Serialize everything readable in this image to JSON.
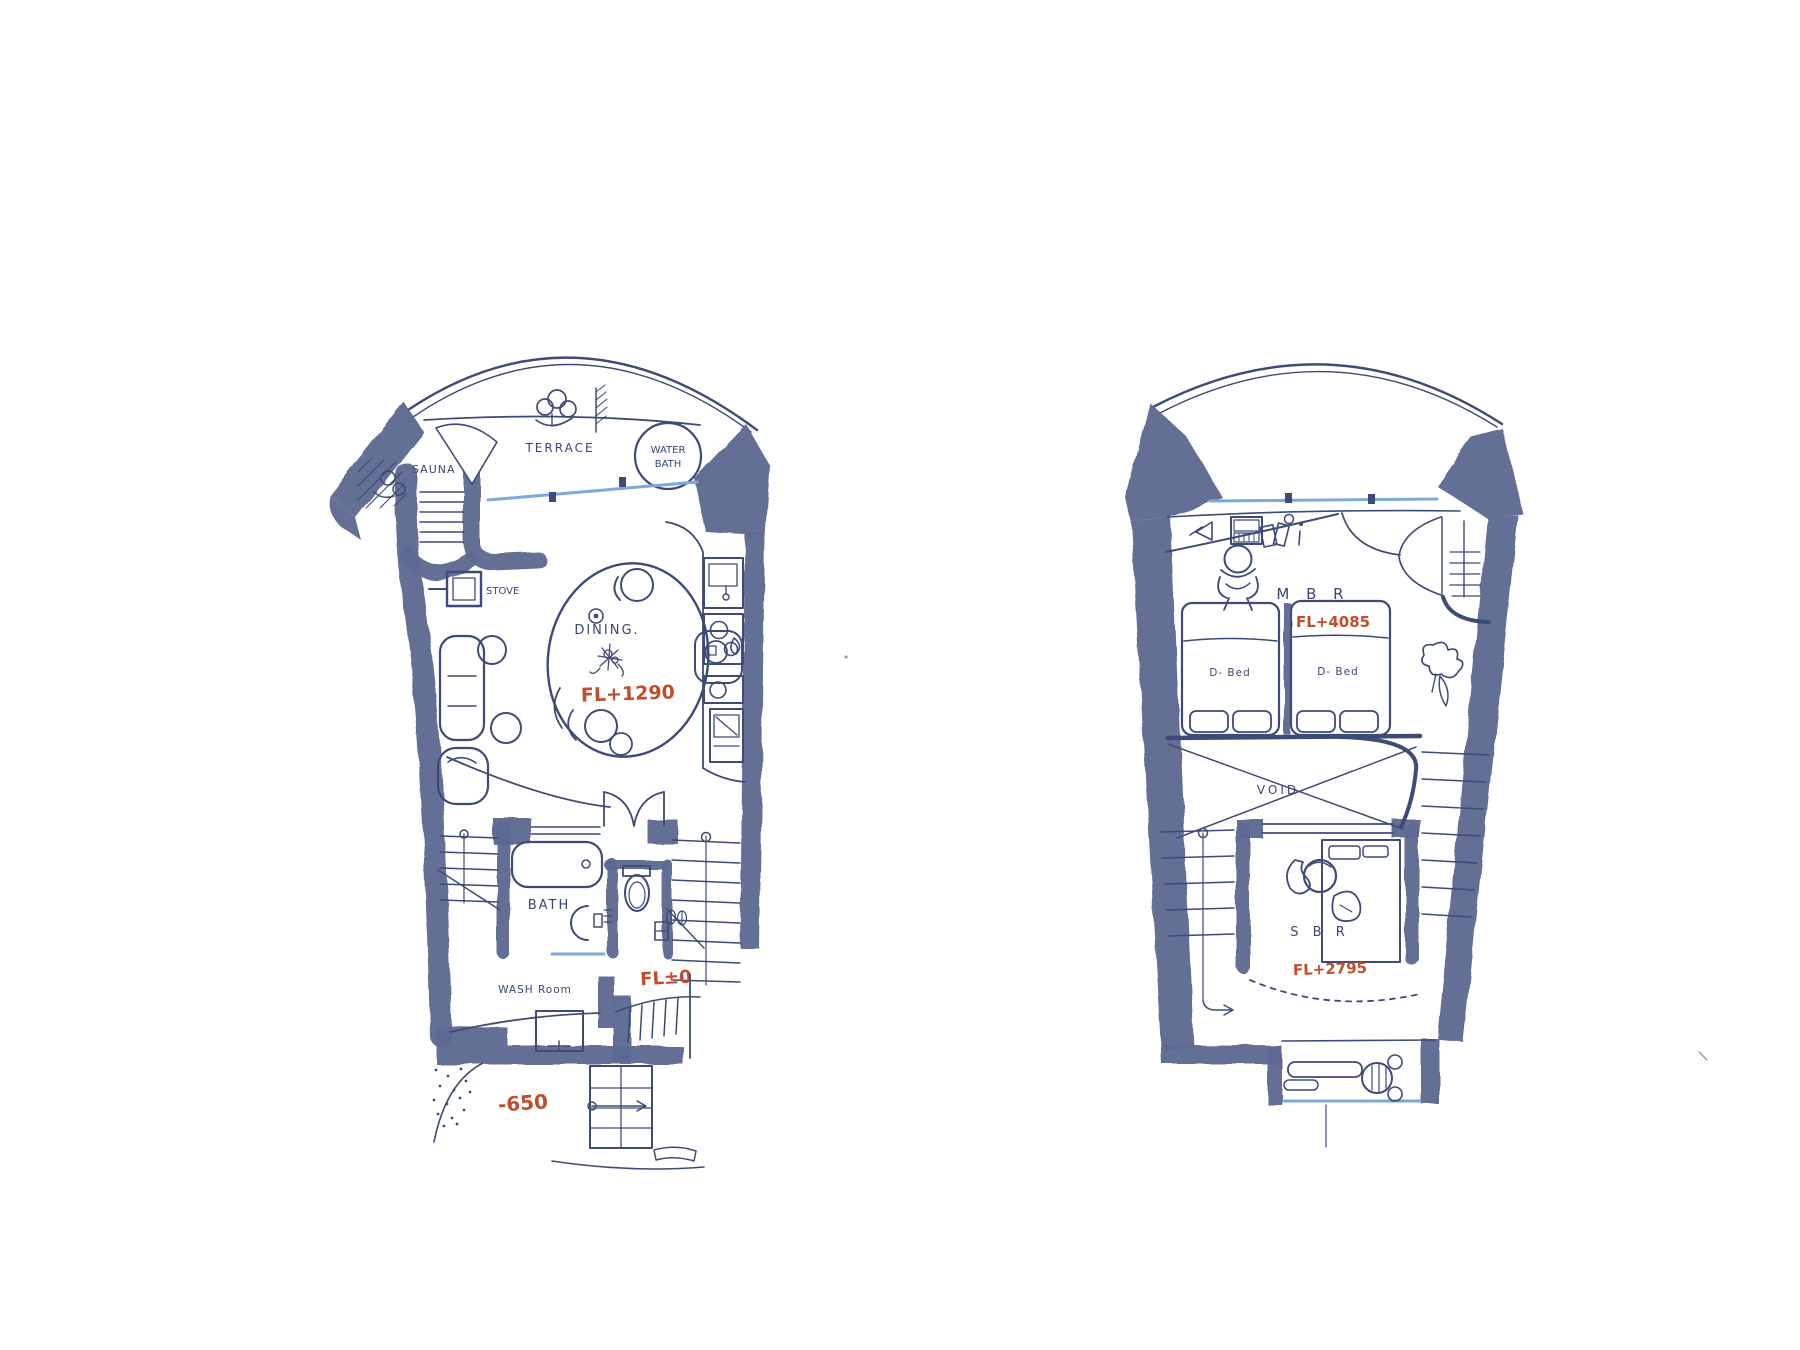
{
  "colors": {
    "ink": "#3e4b77",
    "wall": "#5e6992",
    "accent_red": "#c04e2c",
    "glass_blue": "#7ca9d9",
    "paper": "#ffffff"
  },
  "plans": {
    "lower": {
      "labels": {
        "terrace": "TERRACE",
        "water_bath_line1": "WATER",
        "water_bath_line2": "BATH",
        "sauna": "SAUNA",
        "stove": "STOVE",
        "dining": "DINING.",
        "dining_level": "FL+1290",
        "bath": "BATH",
        "wash_room": "WASH Room",
        "wash_level": "FL±0",
        "entry_level": "-650"
      }
    },
    "upper": {
      "labels": {
        "master_bedroom": "M B R",
        "master_level": "FL+4085",
        "bed_left": "D- Bed",
        "bed_right": "D- Bed",
        "void": "VOID",
        "second_bedroom": "S B R",
        "second_level": "FL+2795"
      }
    }
  }
}
